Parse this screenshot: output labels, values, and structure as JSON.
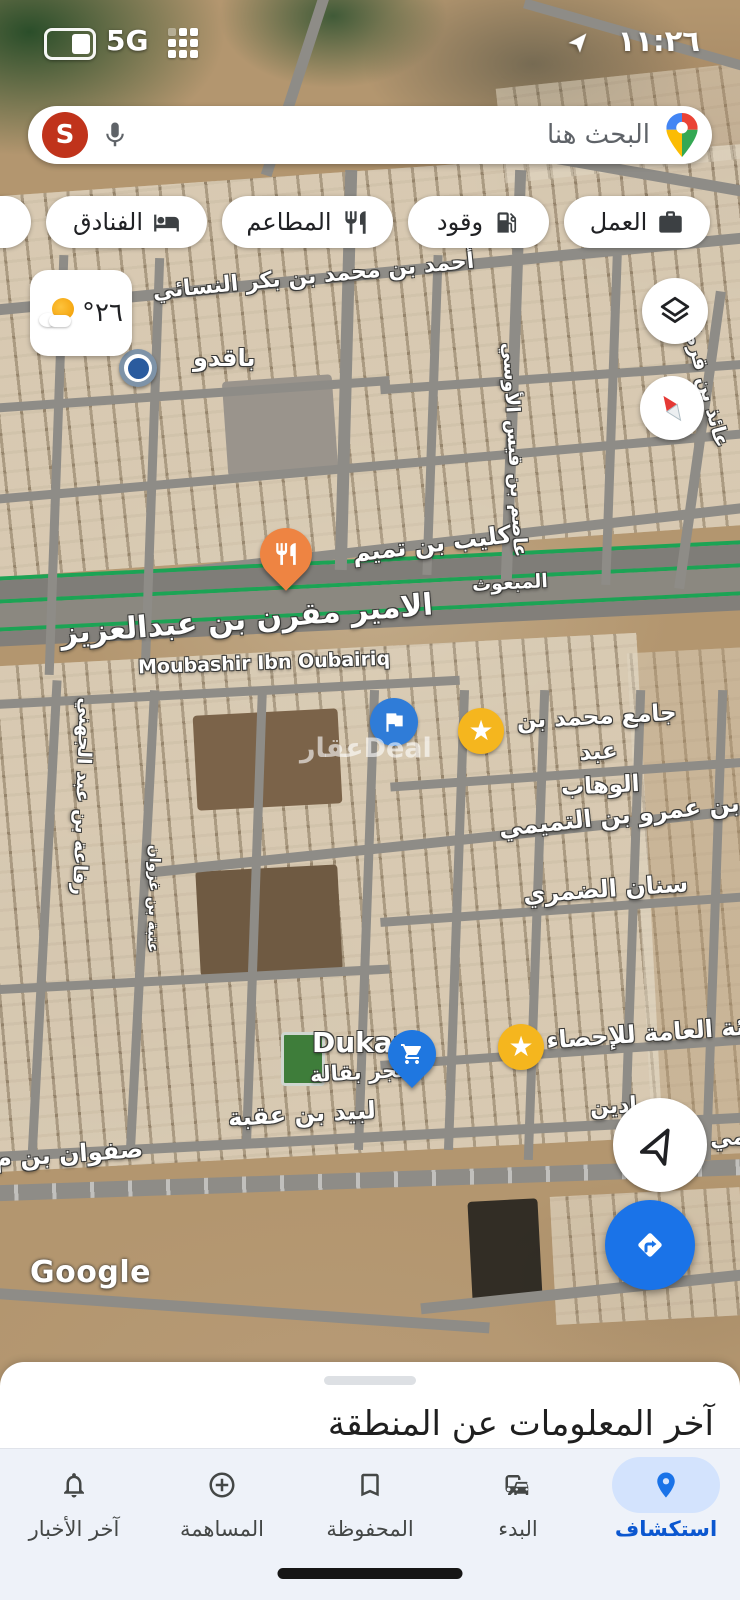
{
  "status": {
    "time": "١١:٢٦",
    "network": "5G"
  },
  "search": {
    "placeholder": "البحث هنا",
    "avatar_letter": "S"
  },
  "chips": [
    {
      "label": "العمل",
      "icon": "briefcase-icon"
    },
    {
      "label": "وقود",
      "icon": "fuel-icon"
    },
    {
      "label": "المطاعم",
      "icon": "restaurant-icon"
    },
    {
      "label": "الفنادق",
      "icon": "hotel-icon"
    },
    {
      "label": "المقا",
      "icon": "coffee-icon"
    }
  ],
  "weather": {
    "temperature": "٢٦°"
  },
  "map": {
    "streets": {
      "ahmad": "أحمد بن محمد بن بكر النسائي",
      "aidh": "عائذ بن قرط",
      "asim": "عاصم بن قيس الأوسي",
      "kulaib": "كليب بن تميم",
      "amir": "الامير مقرن بن عبدالعزيز",
      "mabuth": "المبعوث",
      "moubashir": "Moubashir Ibn Oubairiq",
      "rifaah": "رفاعة بن عبد الجهني",
      "utbah": "عتبة بن غزوان",
      "saeed": "سعيد بن عمرو بن التميمي",
      "sinan": "سنان الضمري",
      "labid": "لبيد بن عقبة",
      "safwan": "صفوان بن م",
      "frag_adin": "ادين",
      "frag_mi": "مي"
    },
    "pois": {
      "baqdu": "باقدو",
      "mosque_line1": "جامع محمد بن عبد",
      "mosque_line2": "الوهاب",
      "dukan_title": "Dukan",
      "dukan_subtitle": "متجر بقالة",
      "stats_authority": "الهيئة العامة للإحصاء"
    },
    "watermark": "عقارDeal",
    "google_logo": "Google"
  },
  "sheet": {
    "title": "آخر المعلومات عن المنطقة"
  },
  "nav": {
    "items": [
      {
        "label": "استكشاف",
        "icon": "explore-pin-icon",
        "active": true
      },
      {
        "label": "البدء",
        "icon": "commute-icon",
        "active": false
      },
      {
        "label": "المحفوظة",
        "icon": "bookmark-icon",
        "active": false
      },
      {
        "label": "المساهمة",
        "icon": "add-circle-icon",
        "active": false
      },
      {
        "label": "آخر الأخبار",
        "icon": "bell-icon",
        "active": false
      }
    ]
  },
  "colors": {
    "accent_blue": "#1a73e8",
    "selected_pill": "#d3e3fd",
    "avatar_red": "#c0331b",
    "star_yellow": "#f5b61e",
    "restaurant_orange": "#ee8442",
    "highway_green": "#1ca355"
  }
}
